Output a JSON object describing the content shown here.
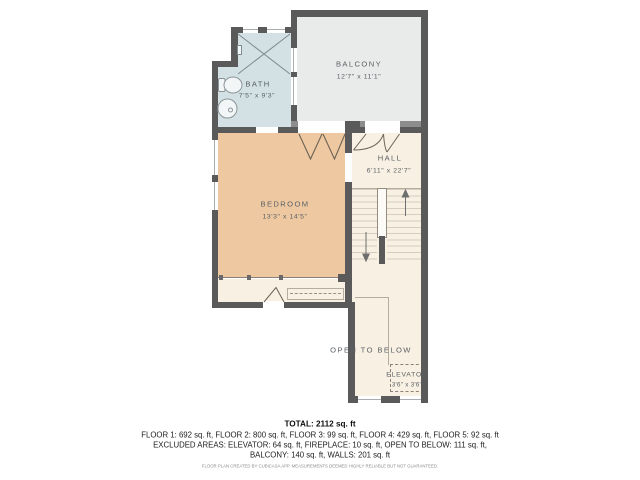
{
  "plan": {
    "rooms": {
      "balcony": {
        "name": "BALCONY",
        "dims": "12'7\" x 11'1\""
      },
      "bath": {
        "name": "BATH",
        "dims": "7'5\" x 9'3\""
      },
      "bedroom": {
        "name": "BEDROOM",
        "dims": "13'3\" x 14'5\""
      },
      "hall": {
        "name": "HALL",
        "dims": "6'11\" x 22'7\""
      },
      "open_to_below": {
        "name": "OPEN TO BELOW"
      },
      "elevator": {
        "name": "ELEVATOR",
        "dims": "3'6\" x 3'6\""
      }
    }
  },
  "summary": {
    "total": "TOTAL: 2112 sq. ft",
    "floors": "FLOOR 1: 692 sq. ft, FLOOR 2: 800 sq. ft, FLOOR 3: 99 sq. ft, FLOOR 4: 429 sq. ft, FLOOR 5: 92 sq. ft",
    "excluded_1": "EXCLUDED AREAS: ELEVATOR: 64 sq. ft, FIREPLACE: 10 sq. ft, OPEN TO BELOW: 111 sq. ft,",
    "excluded_2": "BALCONY: 140 sq. ft, WALLS: 201 sq. ft",
    "disclaimer": "FLOOR PLAN CREATED BY CUBICASA APP. MEASUREMENTS DEEMED HIGHLY RELIABLE BUT NOT GUARANTEED."
  },
  "colors": {
    "wall": "#5a5a5a",
    "balcony_wall": "#8d8d8d",
    "balcony_fill": "#e9eaea",
    "bath_fill": "#d3e1e4",
    "bedroom_fill": "#edc8a1",
    "hall_fill": "#f7f0e3",
    "label_text": "#5b6065"
  }
}
